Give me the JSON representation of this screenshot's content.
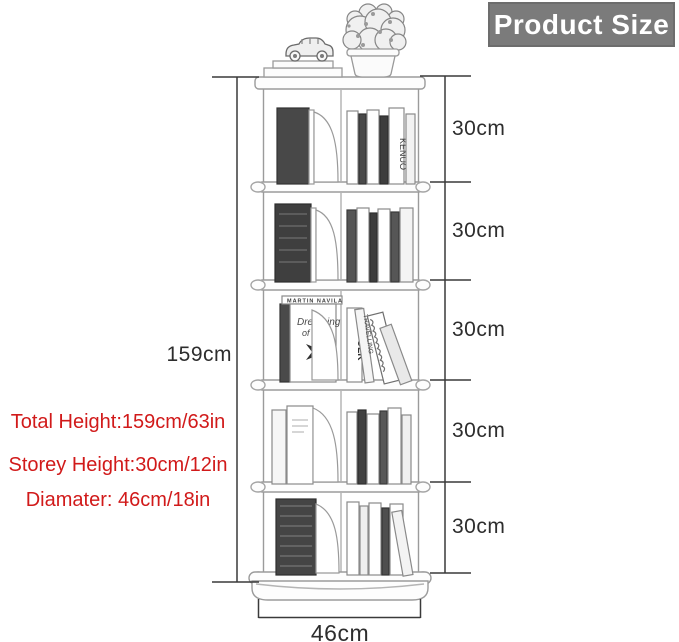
{
  "header": {
    "title": "Product Size"
  },
  "dimensions": {
    "total_height": "159cm",
    "storeys": [
      "30cm",
      "30cm",
      "30cm",
      "30cm",
      "30cm"
    ],
    "diameter": "46cm"
  },
  "specs": {
    "line1": "Total Height:159cm/63in",
    "line2": "Storey Height:30cm/12in",
    "line3": "Diamater: 46cm/18in"
  },
  "illustration": {
    "titles": {
      "kenuo": "KENUO",
      "kinfolk": "KINFOLK",
      "martin": "MARTIN NAVILA",
      "dreaming_line1": "Dreaming",
      "dreaming_line2": "of Sw",
      "travelling": "TRAVELLING"
    }
  },
  "colors": {
    "accent_red": "#d11a1a",
    "header_bg": "#7b7b7b",
    "header_text": "#ffffff",
    "dim_line": "#3a3a3a",
    "sketch_line": "#9b9b9b"
  }
}
